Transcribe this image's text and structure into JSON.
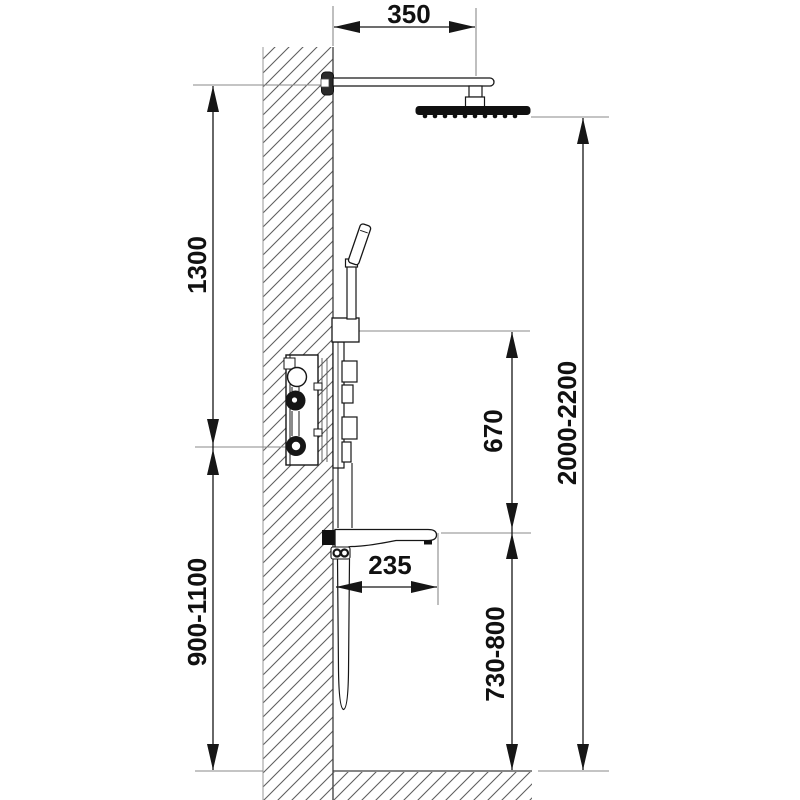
{
  "page": {
    "description": "Technical installation dimension drawing (side view) of a concealed shower system with rain head, hand shower, mixer panel and bath spout mounted on a hatched wall section above a hatched floor section",
    "units": "mm"
  },
  "drawing": {
    "components": {
      "shower_arm": "ceiling/wall shower arm",
      "shower_head": "overhead rain shower head",
      "hand_shower": "hand shower in holder",
      "mixer": "concealed mixer body in wall",
      "panel": "external control panel with handles",
      "spout": "bath spout",
      "hose": "shower hose loop",
      "wall": "wall section hatch",
      "floor": "floor section hatch"
    }
  },
  "dimensions": {
    "arm_projection": {
      "value": "350"
    },
    "arm_to_mixer": {
      "value": "1300"
    },
    "mixer_height": {
      "value": "900-1100"
    },
    "mixer_to_spout": {
      "value": "670"
    },
    "head_height": {
      "value": "2000-2200"
    },
    "spout_projection": {
      "value": "235"
    },
    "spout_height": {
      "value": "730-800"
    }
  },
  "colors": {
    "line": "#161616",
    "hatch": "#5f5f5f",
    "extension_line": "#8a8a8a",
    "text": "#111111",
    "background": "#ffffff"
  }
}
